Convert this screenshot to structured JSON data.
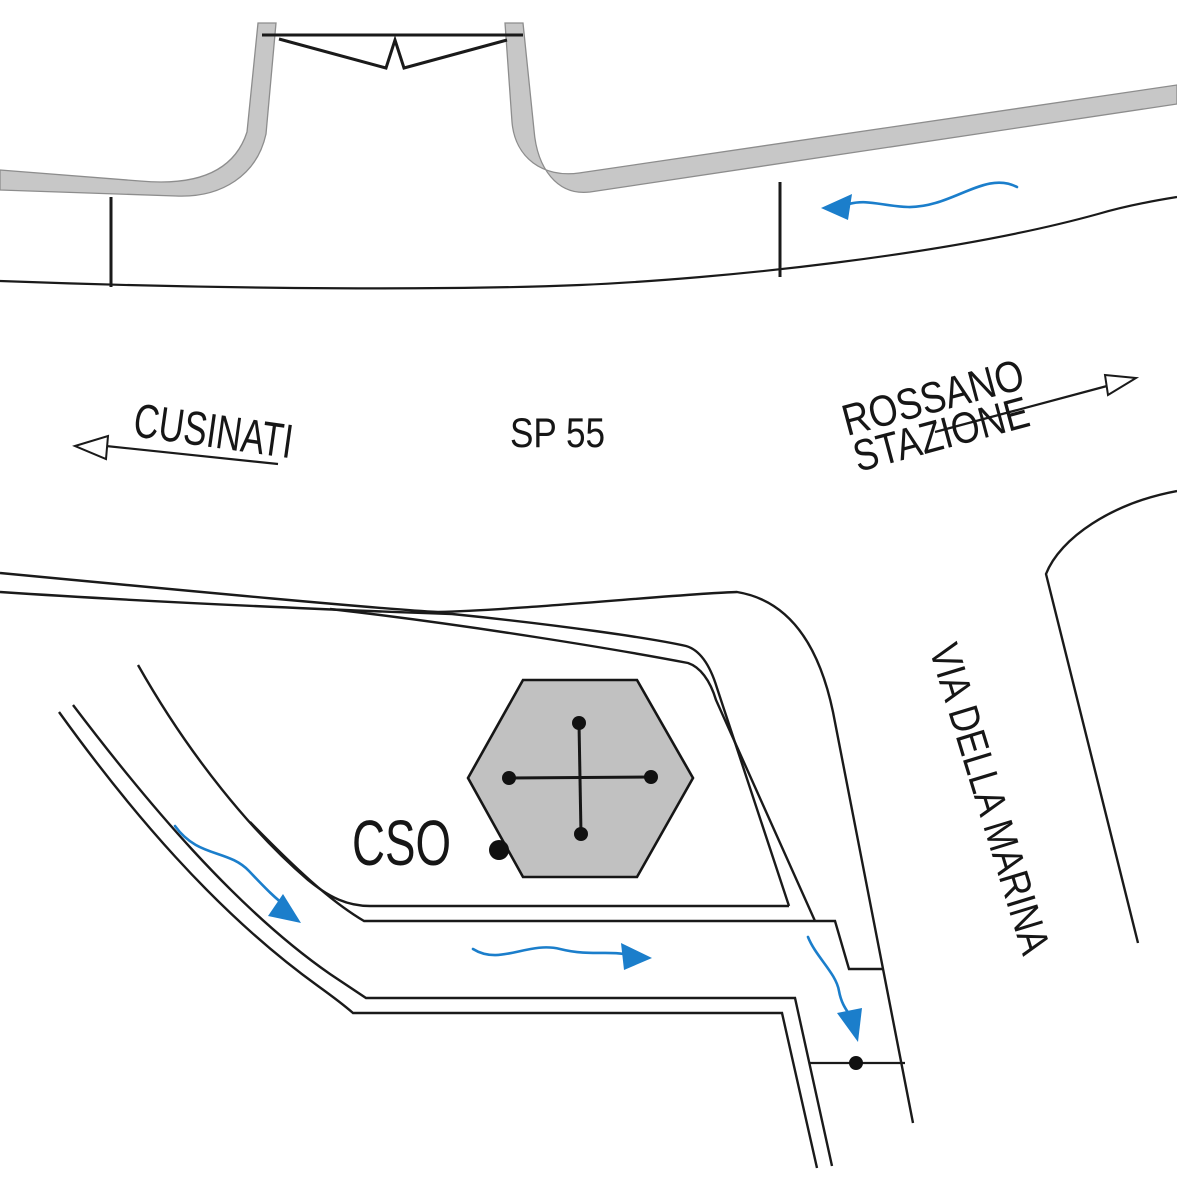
{
  "map": {
    "labels": {
      "cusinati": "CUSINATI",
      "sp55": "SP 55",
      "rossano": "ROSSANO",
      "stazione": "STAZIONE",
      "via_della_marina": "VIA DELLA MARINA",
      "cso": "CSO"
    },
    "colors": {
      "line_black": "#1a1a1a",
      "road_band_gray": "#c7c7c7",
      "band_outline_gray": "#8d8d8d",
      "building_gray": "#c1c1c1",
      "marker_black": "#111111",
      "flow_arrow_blue": "#1b7ecb",
      "background": "#ffffff"
    },
    "markers": [
      {
        "name": "bridge-gap-symbol",
        "shape": "double-triangle-break"
      },
      {
        "name": "hexagon-building",
        "shape": "hexagon-with-dotted-cross"
      },
      {
        "name": "cso-entrance-dot",
        "shape": "filled-dot"
      },
      {
        "name": "junction-dot",
        "shape": "filled-dot-on-line"
      }
    ]
  }
}
